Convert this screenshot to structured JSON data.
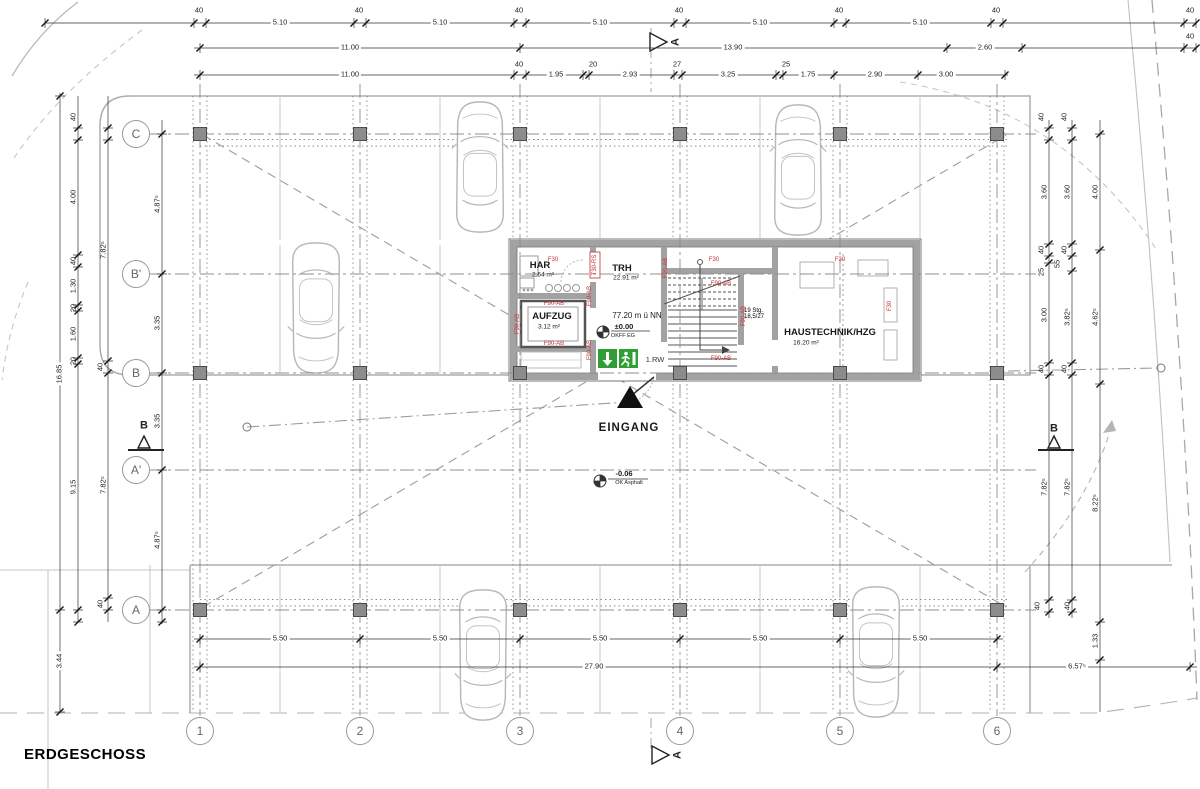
{
  "title": "ERDGESCHOSS",
  "grid": {
    "columns": [
      {
        "label": "1",
        "x": 200
      },
      {
        "label": "2",
        "x": 360
      },
      {
        "label": "3",
        "x": 520
      },
      {
        "label": "4",
        "x": 680
      },
      {
        "label": "5",
        "x": 840
      },
      {
        "label": "6",
        "x": 997
      }
    ],
    "rows": [
      {
        "label": "C",
        "y": 134
      },
      {
        "label": "B'",
        "y": 274
      },
      {
        "label": "B",
        "y": 373
      },
      {
        "label": "A'",
        "y": 470
      },
      {
        "label": "A",
        "y": 610
      }
    ]
  },
  "rooms": {
    "har": {
      "name": "HAR",
      "area": "2.64 m²"
    },
    "aufzug": {
      "name": "AUFZUG",
      "area": "3.12 m²"
    },
    "trh": {
      "name": "TRH",
      "area": "22.91 m²"
    },
    "haustechnik": {
      "name": "HAUSTECHNIK/HZG",
      "area": "16.20 m²"
    }
  },
  "levels": {
    "indoor": {
      "altitude": "77.20 m ü NN",
      "value": "±0.00",
      "ref": "OKFF EG"
    },
    "outdoor": {
      "value": "-0.06",
      "ref": "OK Asphalt"
    }
  },
  "entrance": {
    "label": "EINGANG"
  },
  "escape": {
    "label": "1.RW"
  },
  "stairs": {
    "note_line1": "19 Stg.",
    "note_line2": "18,5/27"
  },
  "colors": {
    "wall": "#a2a2a2",
    "line": "#b5b5b5",
    "red": "#c23030",
    "green": "#2f9e34"
  },
  "labels": [
    {
      "t": "40",
      "x": 199,
      "y": 10
    },
    {
      "t": "5.10",
      "x": 280,
      "y": 22,
      "b": 1
    },
    {
      "t": "40",
      "x": 359,
      "y": 10
    },
    {
      "t": "5.10",
      "x": 440,
      "y": 22,
      "b": 1
    },
    {
      "t": "40",
      "x": 519,
      "y": 10
    },
    {
      "t": "5.10",
      "x": 600,
      "y": 22,
      "b": 1
    },
    {
      "t": "40",
      "x": 679,
      "y": 10
    },
    {
      "t": "5.10",
      "x": 760,
      "y": 22,
      "b": 1
    },
    {
      "t": "40",
      "x": 839,
      "y": 10
    },
    {
      "t": "5.10",
      "x": 920,
      "y": 22,
      "b": 1
    },
    {
      "t": "40",
      "x": 996,
      "y": 10
    },
    {
      "t": "40",
      "x": 1190,
      "y": 10
    },
    {
      "t": "11.00",
      "x": 350,
      "y": 47,
      "b": 1
    },
    {
      "t": "13.90",
      "x": 733,
      "y": 47,
      "b": 1
    },
    {
      "t": "2.60",
      "x": 985,
      "y": 47,
      "b": 1
    },
    {
      "t": "40",
      "x": 1190,
      "y": 36
    },
    {
      "t": "11.00",
      "x": 350,
      "y": 74,
      "b": 1
    },
    {
      "t": "40",
      "x": 519,
      "y": 64
    },
    {
      "t": "1.95",
      "x": 556,
      "y": 74,
      "b": 1
    },
    {
      "t": "20",
      "x": 593,
      "y": 64
    },
    {
      "t": "2.93",
      "x": 630,
      "y": 74,
      "b": 1
    },
    {
      "t": "27",
      "x": 677,
      "y": 64
    },
    {
      "t": "3.25",
      "x": 728,
      "y": 74,
      "b": 1
    },
    {
      "t": "25",
      "x": 786,
      "y": 64
    },
    {
      "t": "1.75",
      "x": 808,
      "y": 74,
      "b": 1
    },
    {
      "t": "2.90",
      "x": 875,
      "y": 74,
      "b": 1
    },
    {
      "t": "3.00",
      "x": 946,
      "y": 74,
      "b": 1
    },
    {
      "t": "5.50",
      "x": 280,
      "y": 638,
      "b": 1
    },
    {
      "t": "5.50",
      "x": 440,
      "y": 638,
      "b": 1
    },
    {
      "t": "5.50",
      "x": 600,
      "y": 638,
      "b": 1
    },
    {
      "t": "5.50",
      "x": 760,
      "y": 638,
      "b": 1
    },
    {
      "t": "5.50",
      "x": 920,
      "y": 638,
      "b": 1
    },
    {
      "t": "27.90",
      "x": 594,
      "y": 666,
      "b": 1
    },
    {
      "t": "6.57⁵",
      "x": 1077,
      "y": 666,
      "b": 1
    },
    {
      "t": "16.85",
      "x": 59,
      "y": 374,
      "r": 1,
      "b": 1
    },
    {
      "t": "3.44",
      "x": 59,
      "y": 661,
      "r": 1,
      "b": 1
    },
    {
      "t": "40",
      "x": 73,
      "y": 117,
      "r": 1
    },
    {
      "t": "4.00",
      "x": 73,
      "y": 197,
      "r": 1
    },
    {
      "t": "40",
      "x": 73,
      "y": 261,
      "r": 1
    },
    {
      "t": "1.30",
      "x": 73,
      "y": 286,
      "r": 1
    },
    {
      "t": "20",
      "x": 73,
      "y": 308,
      "r": 1
    },
    {
      "t": "1.60",
      "x": 73,
      "y": 334,
      "r": 1
    },
    {
      "t": "20",
      "x": 73,
      "y": 361,
      "r": 1
    },
    {
      "t": "9.15",
      "x": 73,
      "y": 487,
      "r": 1
    },
    {
      "t": "7.82⁵",
      "x": 103,
      "y": 250,
      "r": 1
    },
    {
      "t": "40",
      "x": 100,
      "y": 367,
      "r": 1
    },
    {
      "t": "7.82⁵",
      "x": 103,
      "y": 485,
      "r": 1
    },
    {
      "t": "40",
      "x": 100,
      "y": 604,
      "r": 1
    },
    {
      "t": "4.87⁵",
      "x": 157,
      "y": 204,
      "r": 1
    },
    {
      "t": "3.35",
      "x": 157,
      "y": 323,
      "r": 1
    },
    {
      "t": "3.35",
      "x": 157,
      "y": 421,
      "r": 1
    },
    {
      "t": "4.87⁵",
      "x": 157,
      "y": 540,
      "r": 1
    },
    {
      "t": "40",
      "x": 1041,
      "y": 117,
      "r": 1
    },
    {
      "t": "3.60",
      "x": 1044,
      "y": 192,
      "r": 1
    },
    {
      "t": "40",
      "x": 1041,
      "y": 250,
      "r": 1
    },
    {
      "t": "25",
      "x": 1041,
      "y": 272,
      "r": 1
    },
    {
      "t": "3.00",
      "x": 1044,
      "y": 315,
      "r": 1
    },
    {
      "t": "40",
      "x": 1041,
      "y": 369,
      "r": 1
    },
    {
      "t": "7.82⁵",
      "x": 1044,
      "y": 487,
      "r": 1
    },
    {
      "t": "40",
      "x": 1037,
      "y": 606,
      "r": 1
    },
    {
      "t": "40",
      "x": 1064,
      "y": 117,
      "r": 1
    },
    {
      "t": "3.60",
      "x": 1067,
      "y": 192,
      "r": 1
    },
    {
      "t": "40",
      "x": 1064,
      "y": 250,
      "r": 1
    },
    {
      "t": "55",
      "x": 1057,
      "y": 264,
      "r": 1
    },
    {
      "t": "3.82⁵",
      "x": 1067,
      "y": 317,
      "r": 1
    },
    {
      "t": "40",
      "x": 1064,
      "y": 369,
      "r": 1
    },
    {
      "t": "7.82⁵",
      "x": 1067,
      "y": 487,
      "r": 1
    },
    {
      "t": "40",
      "x": 1067,
      "y": 606,
      "r": 1
    },
    {
      "t": "4.00",
      "x": 1095,
      "y": 192,
      "r": 1
    },
    {
      "t": "4.62⁵",
      "x": 1095,
      "y": 317,
      "r": 1
    },
    {
      "t": "8.22⁵",
      "x": 1095,
      "y": 503,
      "r": 1
    },
    {
      "t": "1.33",
      "x": 1095,
      "y": 641,
      "r": 1
    },
    {
      "t": "A",
      "x": 676,
      "y": 42,
      "c": "sec",
      "r": 1
    },
    {
      "t": "A",
      "x": 678,
      "y": 755,
      "c": "sec",
      "r": 1
    },
    {
      "t": "B",
      "x": 144,
      "y": 426,
      "c": "sec"
    },
    {
      "t": "B",
      "x": 1054,
      "y": 429,
      "c": "sec"
    },
    {
      "t": "F30",
      "x": 553,
      "y": 260,
      "c": "red"
    },
    {
      "t": "F30",
      "x": 714,
      "y": 260,
      "c": "red"
    },
    {
      "t": "F30",
      "x": 840,
      "y": 260,
      "c": "red"
    },
    {
      "t": "F90-AB",
      "x": 554,
      "y": 304,
      "c": "red"
    },
    {
      "t": "F90-AB",
      "x": 554,
      "y": 344,
      "c": "red"
    },
    {
      "t": "F90-AB",
      "x": 721,
      "y": 284,
      "c": "red"
    },
    {
      "t": "F90-AB",
      "x": 721,
      "y": 359,
      "c": "red"
    },
    {
      "t": "F90-AB",
      "x": 518,
      "y": 324,
      "c": "red",
      "r": 1
    },
    {
      "t": "F90-AB",
      "x": 590,
      "y": 296,
      "c": "red",
      "r": 1
    },
    {
      "t": "F90-AB",
      "x": 590,
      "y": 350,
      "c": "red",
      "r": 1
    },
    {
      "t": "F90-AB",
      "x": 666,
      "y": 268,
      "c": "red",
      "r": 1
    },
    {
      "t": "F90-AB",
      "x": 744,
      "y": 316,
      "c": "red",
      "r": 1
    },
    {
      "t": "T30-RS",
      "x": 595,
      "y": 265,
      "c": "red",
      "r": 1
    },
    {
      "t": "F30",
      "x": 890,
      "y": 306,
      "c": "red",
      "r": 1
    }
  ]
}
